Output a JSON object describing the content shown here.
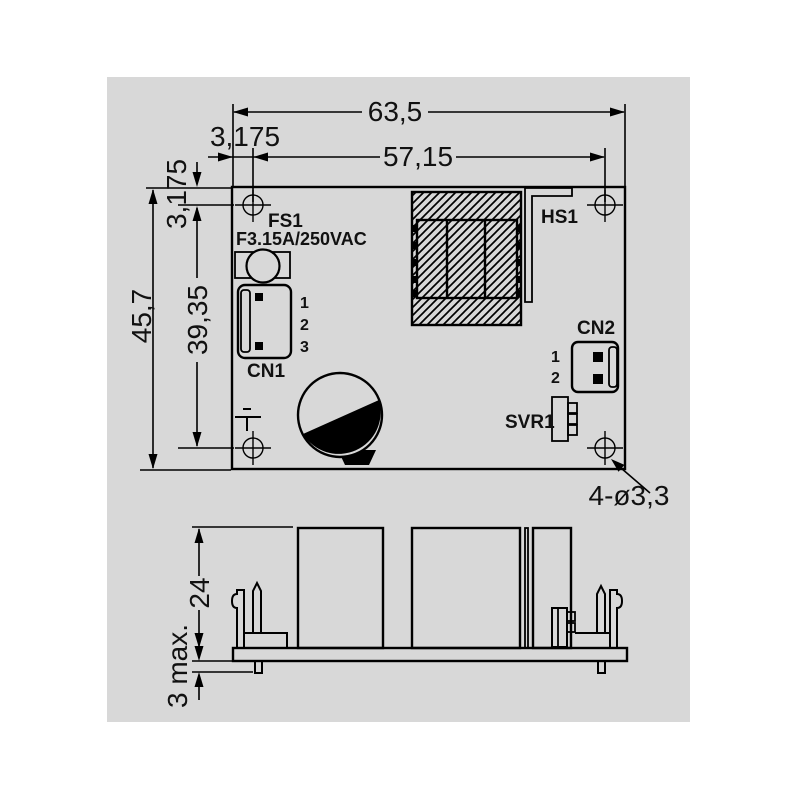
{
  "colors": {
    "panel": "#d8d8d8",
    "line": "#000000"
  },
  "top_view": {
    "dim_total_width": "63,5",
    "dim_edge_offset_h": "3,175",
    "dim_hole_pitch_h": "57,15",
    "dim_edge_offset_v": "3,175",
    "dim_total_height": "45,7",
    "dim_hole_pitch_v": "39,35",
    "dim_mounting_holes": "4-ø3,3",
    "fuse_ref": "FS1",
    "fuse_rating": "F3.15A/250VAC",
    "cn1_label": "CN1",
    "cn1_pins": [
      "1",
      "2",
      "3"
    ],
    "cn2_label": "CN2",
    "cn2_pins": [
      "1",
      "2"
    ],
    "svr_label": "SVR1",
    "heatsink_label": "HS1"
  },
  "side_view": {
    "dim_height": "24",
    "dim_pin_protrusion": "3 max."
  }
}
